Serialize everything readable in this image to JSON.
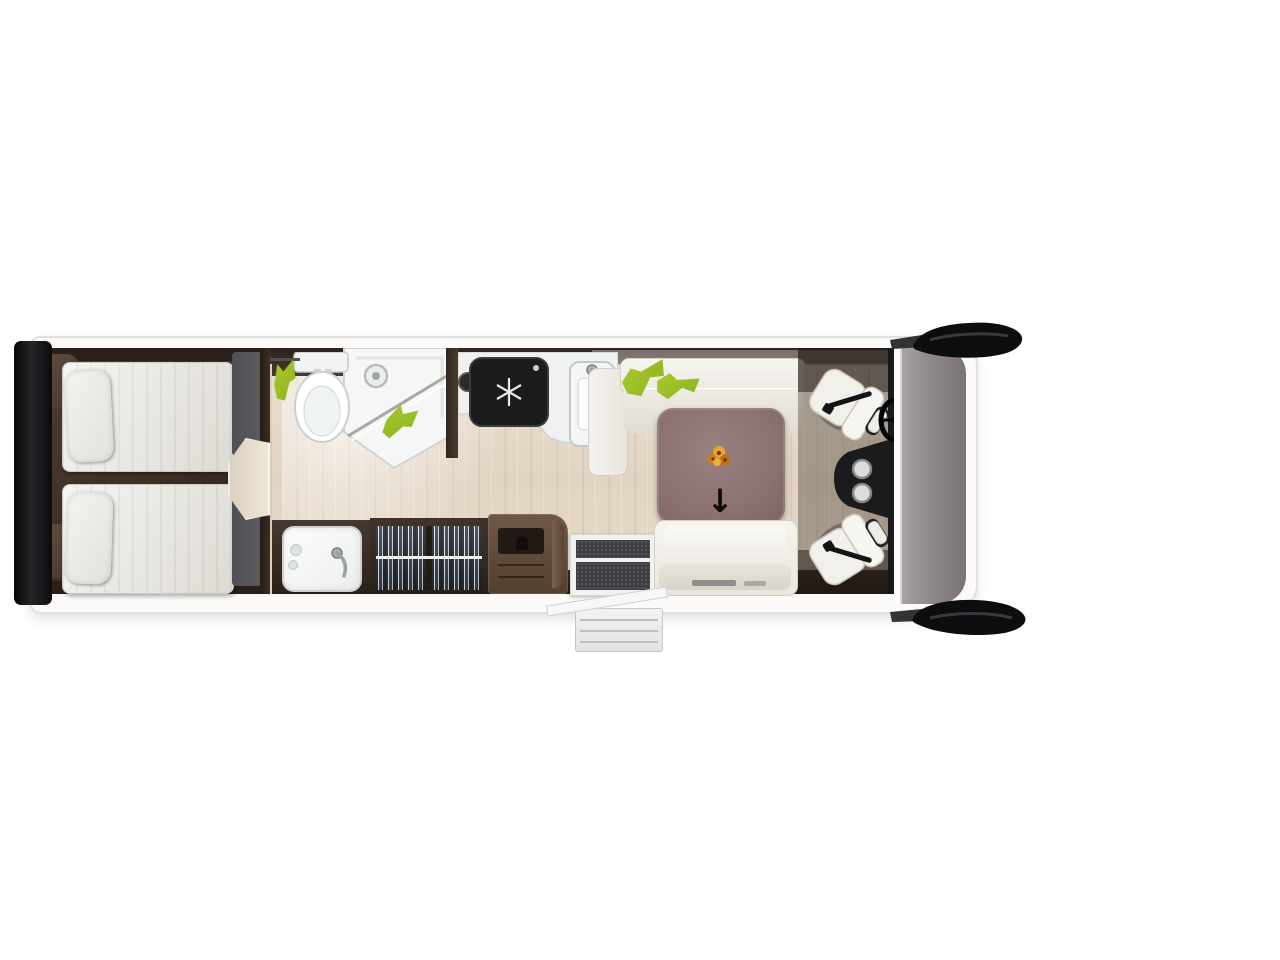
{
  "meta": {
    "description": "Top-down 3D floor plan of a motorhome interior"
  },
  "icons": {
    "arrow_down": "↓"
  },
  "areas": [
    "rear-twin-bedroom",
    "washroom-toilet",
    "shower",
    "dressing-wardrobe",
    "washbasin",
    "kitchen",
    "dinette",
    "entry-door",
    "rear-bench-sofa",
    "driver-cab"
  ],
  "palette": {
    "bg": "#ffffff",
    "body": "#fbfaf9",
    "outline": "#e2e0dd",
    "dark_wood": "#453730",
    "lime": "#a9c92d",
    "lime_dark": "#8cb21f",
    "table": "#8b7170",
    "seat": "#f2f0ea",
    "hob": "#1b1c1e",
    "dash": "#15161a",
    "mirror": "#0d0d0f",
    "floor": "#e6dac9",
    "bed_gray": "#55545a"
  }
}
